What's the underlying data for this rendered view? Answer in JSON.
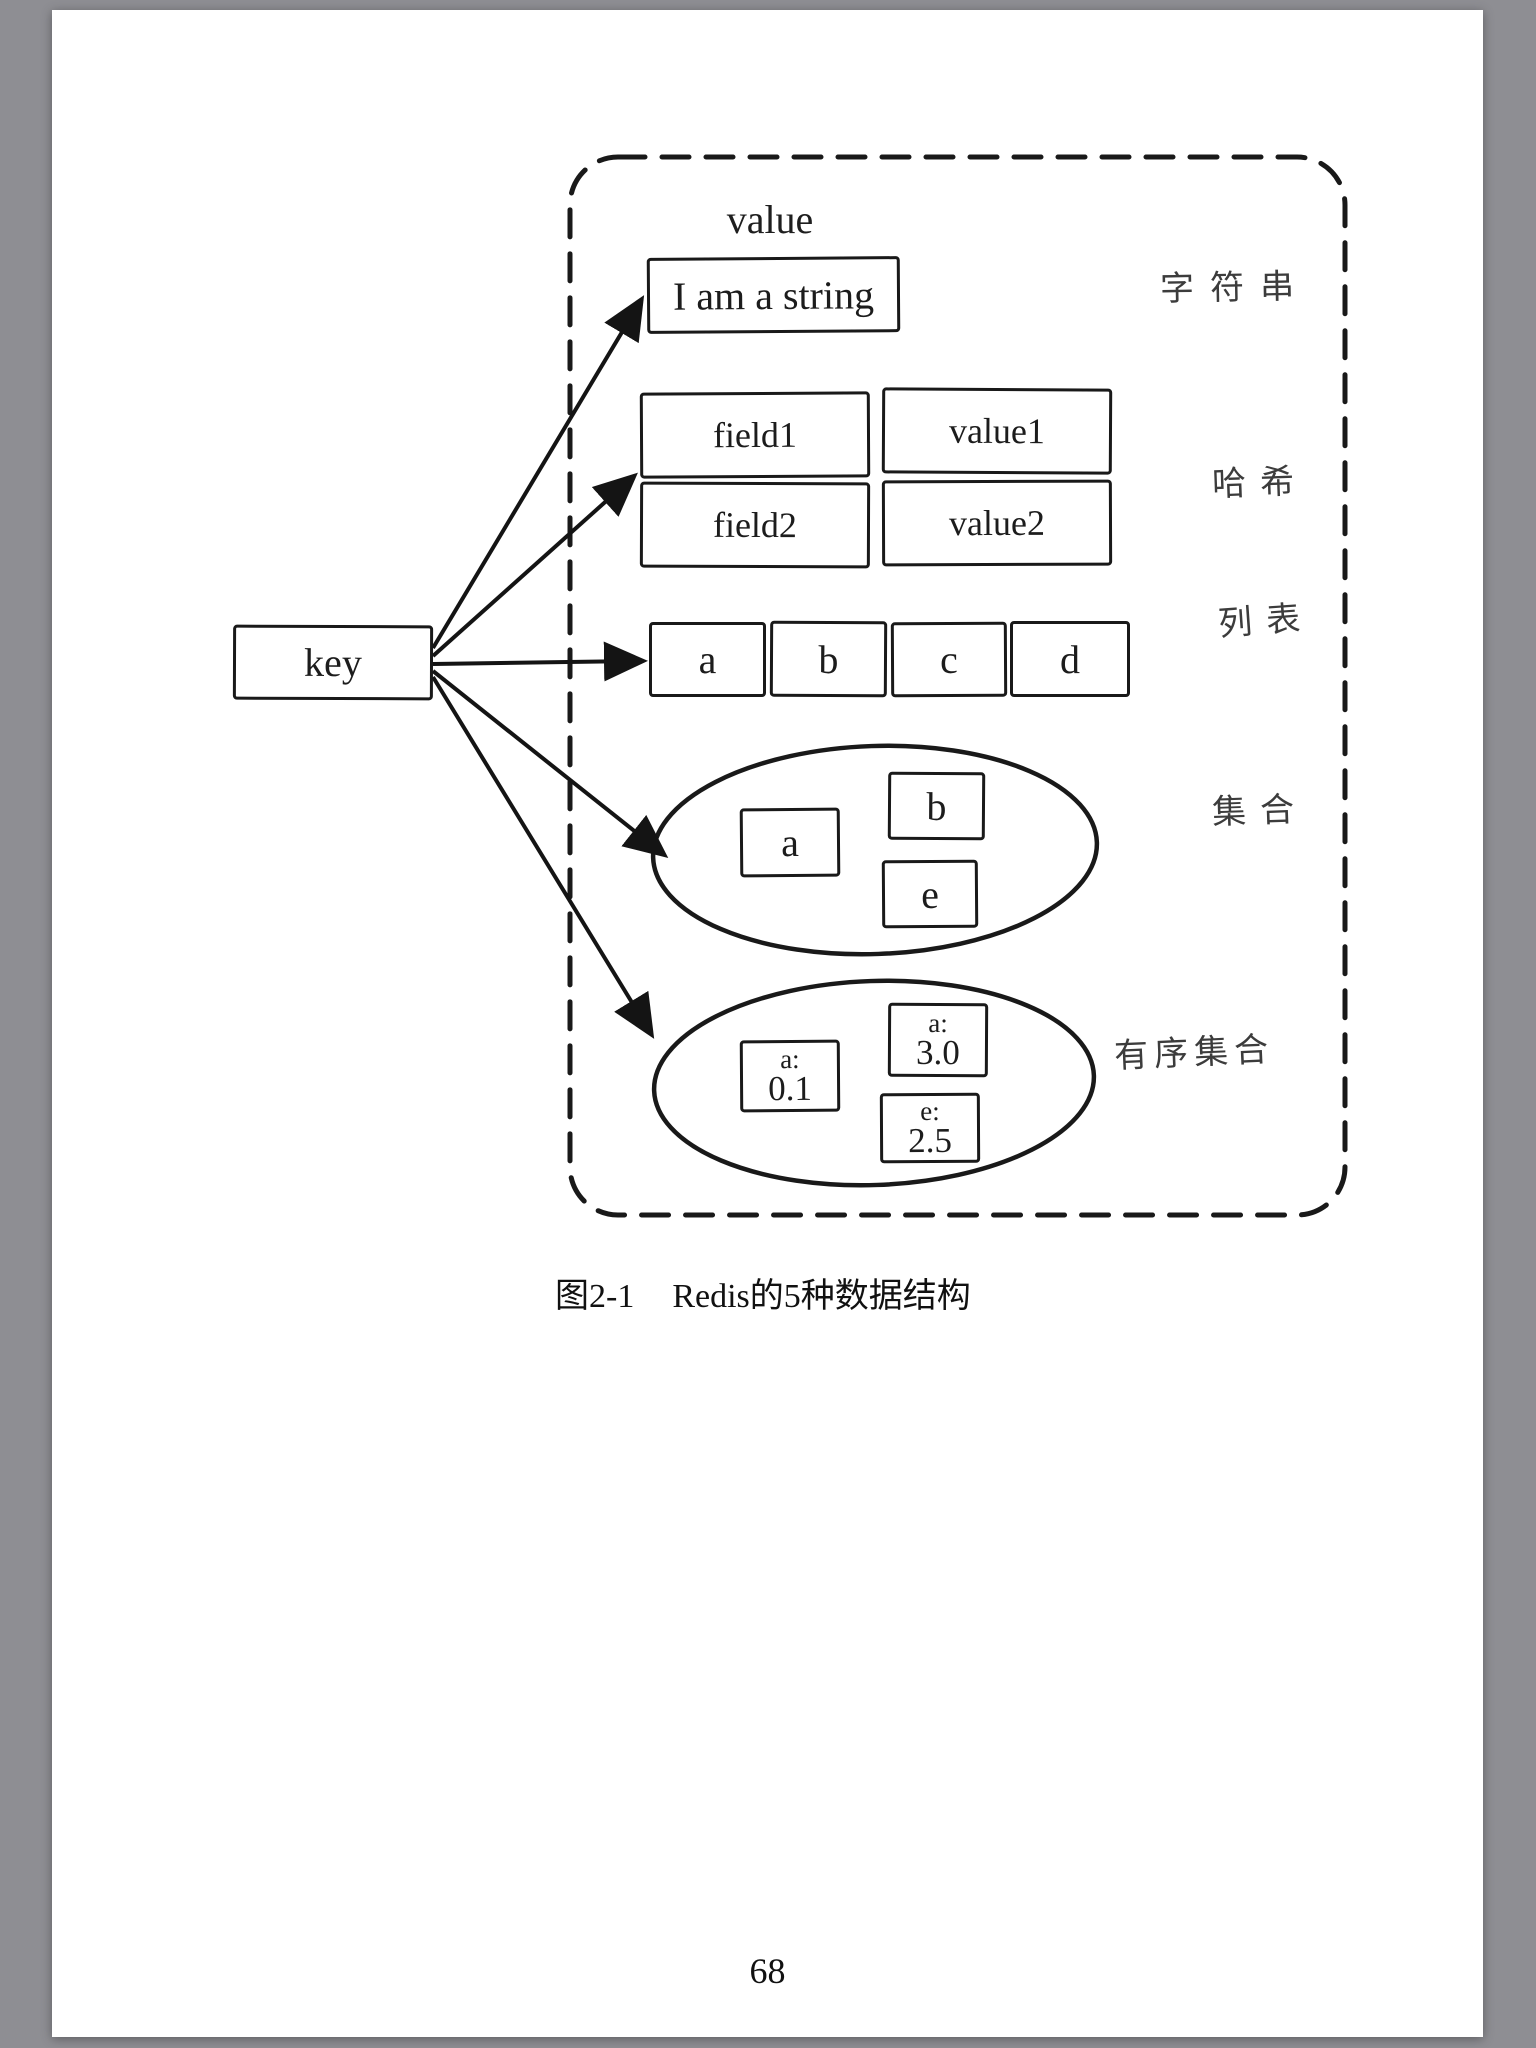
{
  "page": {
    "caption": {
      "figure_label": "图2-1",
      "figure_title": "Redis的5种数据结构"
    },
    "page_number": "68"
  },
  "diagram": {
    "key_label": "key",
    "value_header": "value",
    "colors": {
      "reader_background": "#8e8e93",
      "page_background": "#ffffff",
      "ink": "#191919"
    },
    "structures": [
      {
        "type_label": "字符串",
        "content": "I am a string"
      },
      {
        "type_label": "哈希",
        "rows": [
          [
            "field1",
            "value1"
          ],
          [
            "field2",
            "value2"
          ]
        ]
      },
      {
        "type_label": "列表",
        "items": [
          "a",
          "b",
          "c",
          "d"
        ]
      },
      {
        "type_label": "集合",
        "members": [
          "a",
          "b",
          "e"
        ]
      },
      {
        "type_label": "有序集合",
        "members": [
          {
            "member": "a:",
            "score": "0.1"
          },
          {
            "member": "a:",
            "score": "3.0"
          },
          {
            "member": "e:",
            "score": "2.5"
          }
        ]
      }
    ]
  }
}
